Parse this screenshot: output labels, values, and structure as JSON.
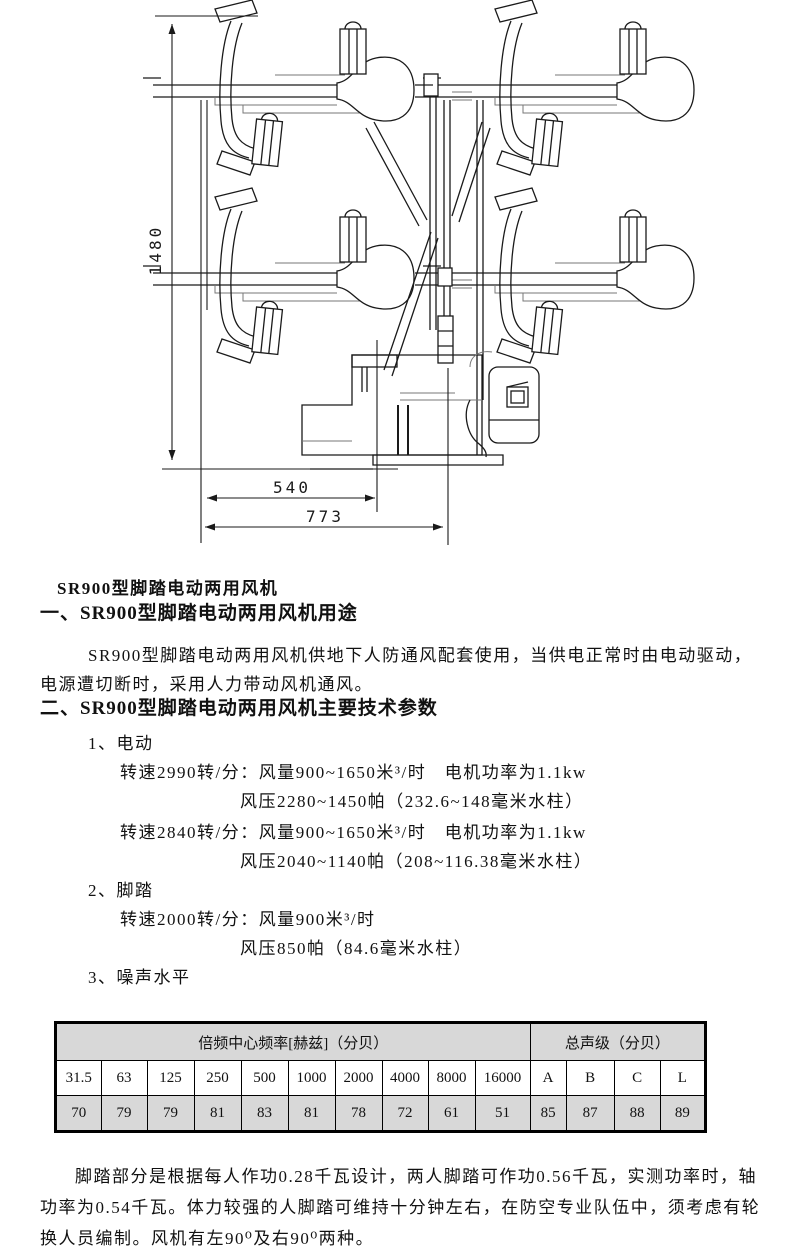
{
  "drawing": {
    "dims": {
      "height": "1480",
      "inner_width": "540",
      "outer_width": "773"
    }
  },
  "doc": {
    "title": "SR900型脚踏电动两用风机",
    "section1": {
      "heading": "一、SR900型脚踏电动两用风机用途",
      "line1": "SR900型脚踏电动两用风机供地下人防通风配套使用，当供电正常时由电动驱动，",
      "line2": "电源遭切断时，采用人力带动风机通风。"
    },
    "section2": {
      "heading": "二、SR900型脚踏电动两用风机主要技术参数",
      "electric_label": "1、电动",
      "electric_line1": "转速2990转/分：风量900~1650米³/时　电机功率为1.1kw",
      "electric_line2": "风压2280~1450帕（232.6~148毫米水柱）",
      "electric_line3": "转速2840转/分：风量900~1650米³/时　电机功率为1.1kw",
      "electric_line4": "风压2040~1140帕（208~116.38毫米水柱）",
      "pedal_label": "2、脚踏",
      "pedal_line1": "转速2000转/分：风量900米³/时",
      "pedal_line2": "风压850帕（84.6毫米水柱）",
      "noise_label": "3、噪声水平"
    },
    "closing": {
      "line1": "脚踏部分是根据每人作功0.28千瓦设计，两人脚踏可作功0.56千瓦，实测功率时，轴",
      "line2": "功率为0.54千瓦。体力较强的人脚踏可维持十分钟左右，在防空专业队伍中，须考虑有轮",
      "line3": "换人员编制。风机有左90⁰及右90⁰两种。"
    }
  },
  "table": {
    "group1_header": "倍频中心频率[赫兹]（分贝）",
    "group2_header": "总声级（分贝）",
    "freq_cols": [
      "31.5",
      "63",
      "125",
      "250",
      "500",
      "1000",
      "2000",
      "4000",
      "8000",
      "16000"
    ],
    "level_cols": [
      "A",
      "B",
      "C",
      "L"
    ],
    "freq_values": [
      "70",
      "79",
      "79",
      "81",
      "83",
      "81",
      "78",
      "72",
      "61",
      "51"
    ],
    "level_values": [
      "85",
      "87",
      "88",
      "89"
    ]
  }
}
